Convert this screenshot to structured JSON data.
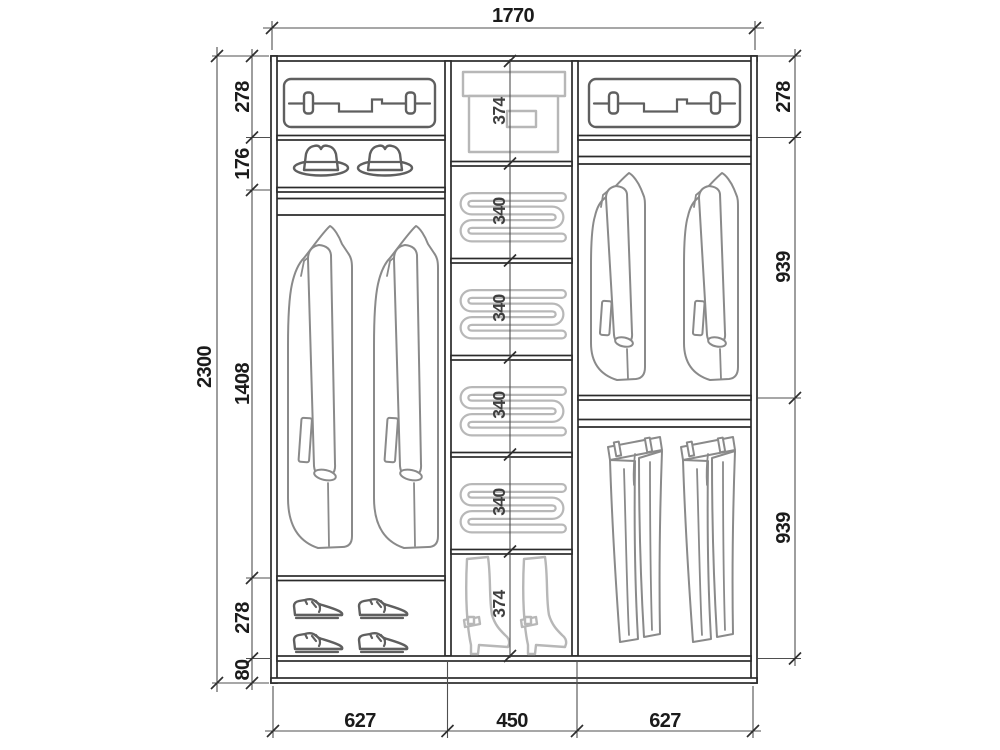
{
  "page": {
    "background": "#ffffff",
    "description": "Wardrobe interior elevation drawing with dimensions in millimetres"
  },
  "dims": {
    "total_width": "1770",
    "total_height": "2300",
    "left_column": {
      "suitcase_shelf_height": "278",
      "hat_shelf_height": "176",
      "hanging_height": "1408",
      "shoe_shelf_height": "278",
      "plinth_height": "80"
    },
    "middle_column": {
      "top_box_height": "374",
      "shelf_heights": [
        "340",
        "340",
        "340",
        "340"
      ],
      "boot_height": "374"
    },
    "right_column": {
      "suitcase_shelf_height": "278",
      "jacket_height": "939",
      "trouser_height": "939"
    },
    "bottom_widths": {
      "left": "627",
      "middle": "450",
      "right": "627"
    }
  },
  "colors": {
    "cabinet_line": "#2b2b2b",
    "dimension_line": "#4f4f4f",
    "label_text": "#1b1b1b",
    "icon_dark": "#5f5f5f",
    "icon_medium": "#8a8a8a",
    "icon_light": "#b7b7b7"
  },
  "icons": [
    "suitcase-icon",
    "hat-icon",
    "coat-icon",
    "shoe-icon",
    "storage-box-icon",
    "folded-clothes-icon",
    "boot-icon",
    "jacket-icon",
    "trousers-icon"
  ]
}
